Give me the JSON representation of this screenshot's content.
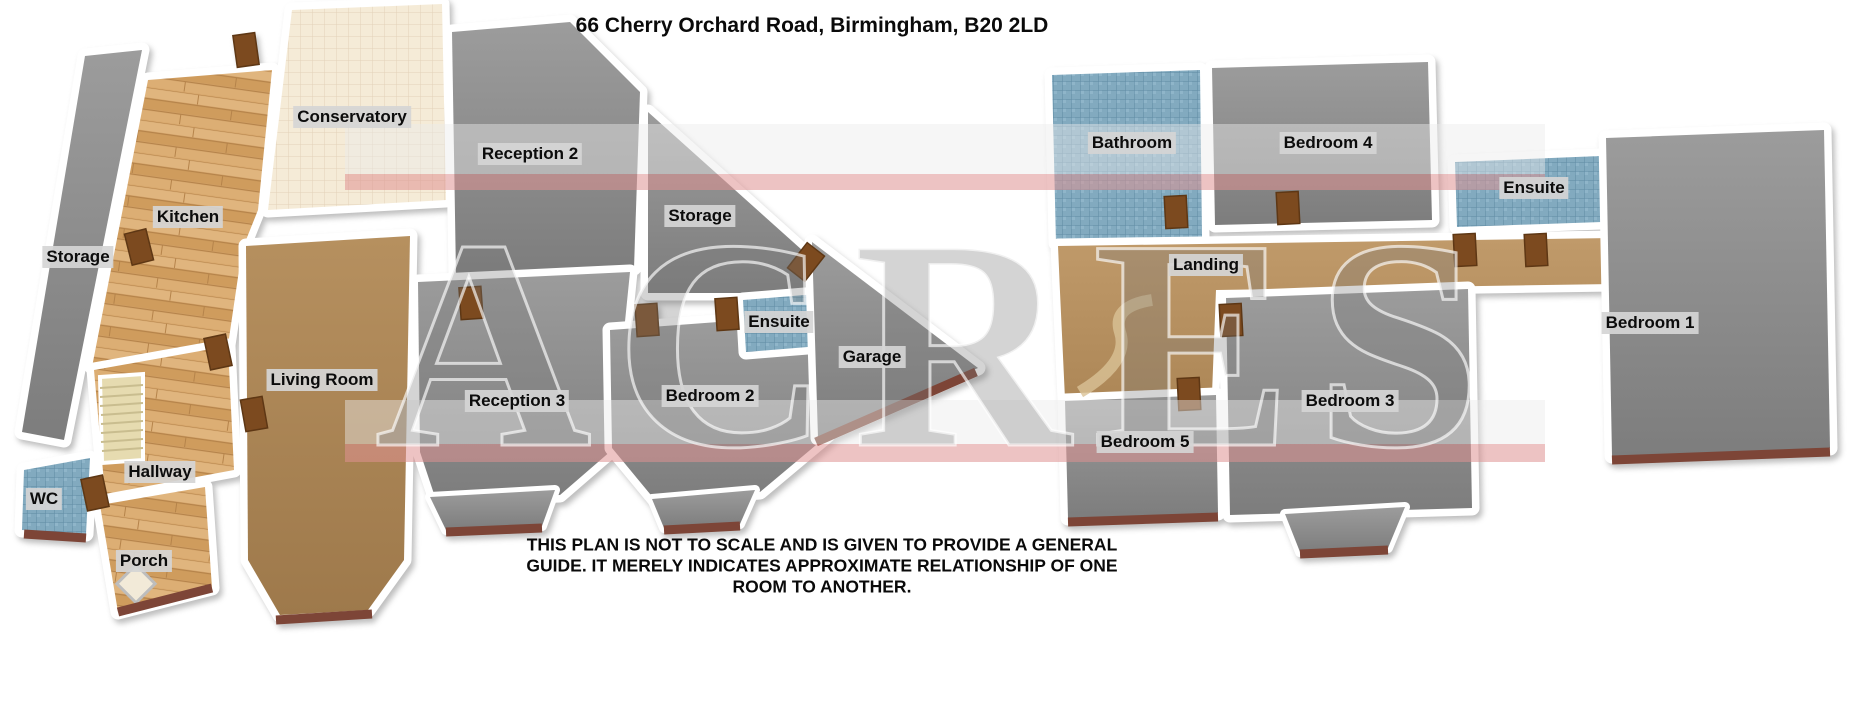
{
  "title": "66 Cherry Orchard Road, Birmingham, B20 2LD",
  "watermark": "ACRES",
  "disclaimer": "THIS PLAN IS NOT TO SCALE AND IS GIVEN TO PROVIDE A GENERAL GUIDE. IT MERELY INDICATES APPROXIMATE RELATIONSHIP OF ONE ROOM TO ANOTHER.",
  "floors": {
    "ground": {
      "rooms": {
        "storage_left": "Storage",
        "kitchen": "Kitchen",
        "conservatory": "Conservatory",
        "reception2": "Reception 2",
        "storage": "Storage",
        "living_room": "Living Room",
        "hallway": "Hallway",
        "wc": "WC",
        "porch": "Porch",
        "reception3": "Reception 3",
        "bedroom2": "Bedroom 2",
        "ensuite": "Ensuite",
        "garage": "Garage"
      }
    },
    "first": {
      "rooms": {
        "bathroom": "Bathroom",
        "bedroom4": "Bedroom 4",
        "ensuite": "Ensuite",
        "landing": "Landing",
        "bedroom1": "Bedroom 1",
        "bedroom5": "Bedroom 5",
        "bedroom3": "Bedroom 3"
      }
    }
  },
  "colors": {
    "wall": "#ffffff",
    "carpet_gray": "#8f8f8f",
    "carpet_brown": "#ae8757",
    "wood": "#d9a96e",
    "tile_blue": "#82aabf",
    "tile_cream": "#f5ebd7",
    "brick": "#7d4537",
    "door": "#7c4a1f",
    "watermark_stripe": "#de9191"
  }
}
